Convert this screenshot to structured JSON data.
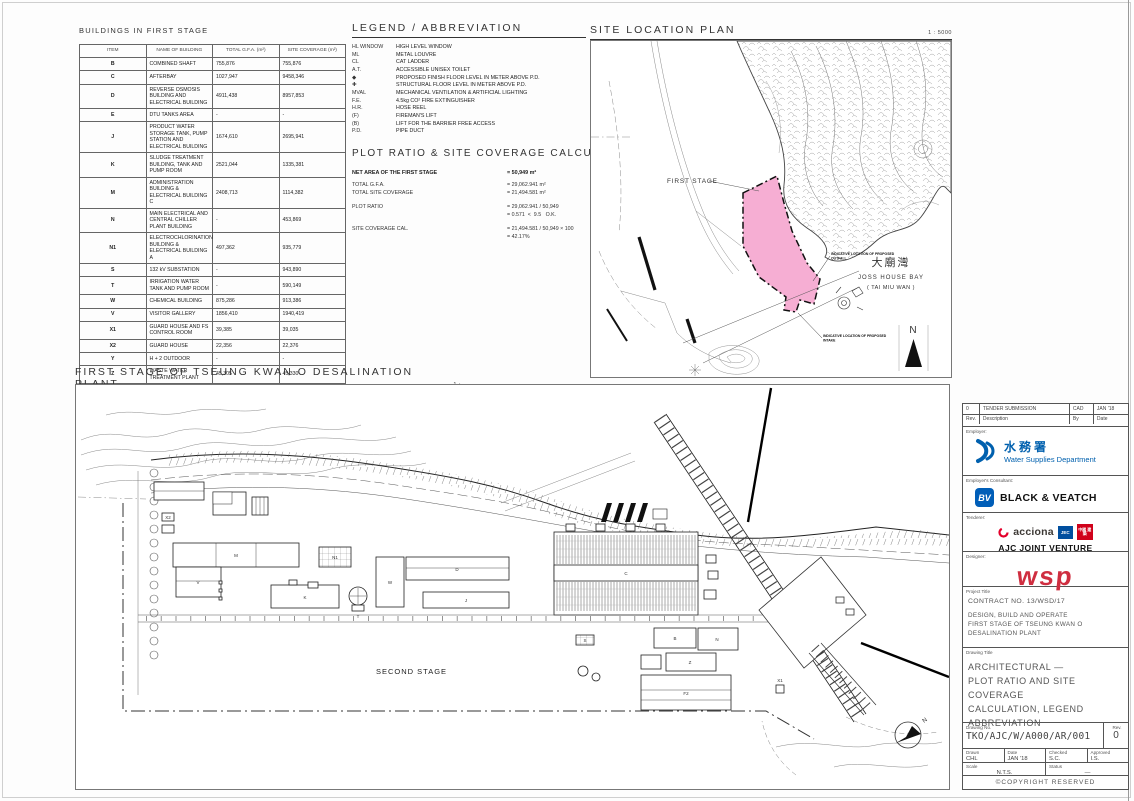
{
  "buildings_table": {
    "title": "BUILDINGS IN FIRST STAGE",
    "headers": [
      "ITEM",
      "NAME OF BUILDING",
      "TOTAL G.F.A. (m²)",
      "SITE COVERAGE (m²)"
    ],
    "rows": [
      {
        "item": "B",
        "name": "COMBINED SHAFT",
        "gfa": "755,876",
        "coverage": "755,876"
      },
      {
        "item": "C",
        "name": "AFTERBAY",
        "gfa": "1027,947",
        "coverage": "9458,346"
      },
      {
        "item": "D",
        "name": "REVERSE OSMOSIS BUILDING AND ELECTRICAL BUILDING",
        "gfa": "4911,438",
        "coverage": "8957,853"
      },
      {
        "item": "E",
        "name": "DTU TANKS AREA",
        "gfa": "-",
        "coverage": "-"
      },
      {
        "item": "J",
        "name": "PRODUCT WATER STORAGE TANK, PUMP STATION AND ELECTRICAL BUILDING",
        "gfa": "1674,610",
        "coverage": "2695,941"
      },
      {
        "item": "K",
        "name": "SLUDGE TREATMENT BUILDING, TANK AND PUMP ROOM",
        "gfa": "2521,044",
        "coverage": "1335,381"
      },
      {
        "item": "M",
        "name": "ADMINISTRATION BUILDING & ELECTRICAL BUILDING C",
        "gfa": "2408,713",
        "coverage": "1114,382"
      },
      {
        "item": "N",
        "name": "MAIN ELECTRICAL AND CENTRAL CHILLER PLANT BUILDING",
        "gfa": "-",
        "coverage": "453,869"
      },
      {
        "item": "N1",
        "name": "ELECTROCHLORINATION BUILDING & ELECTRICAL BUILDING A",
        "gfa": "497,362",
        "coverage": "935,779"
      },
      {
        "item": "S",
        "name": "132 kV SUBSTATION",
        "gfa": "-",
        "coverage": "943,890"
      },
      {
        "item": "T",
        "name": "IRRIGATION WATER TANK AND PUMP ROOM",
        "gfa": "-",
        "coverage": "590,149"
      },
      {
        "item": "W",
        "name": "CHEMICAL BUILDING",
        "gfa": "875,286",
        "coverage": "913,386"
      },
      {
        "item": "V",
        "name": "VISITOR GALLERY",
        "gfa": "1856,410",
        "coverage": "1940,419"
      },
      {
        "item": "X1",
        "name": "GUARD HOUSE AND FS CONTROL ROOM",
        "gfa": "39,385",
        "coverage": "39,035"
      },
      {
        "item": "X2",
        "name": "GUARD HOUSE",
        "gfa": "22,356",
        "coverage": "22,376"
      },
      {
        "item": "Y",
        "name": "H + 2 OUTDOOR",
        "gfa": "-",
        "coverage": "-"
      },
      {
        "item": "Z",
        "name": "WASTE WATER TREATMENT PLANT",
        "gfa": "45,305",
        "coverage": "45,330"
      }
    ],
    "total_label": "TOTAL =",
    "total_gfa": "29175,523",
    "total_coverage": "21494,225"
  },
  "legend": {
    "title": "LEGEND / ABBREVIATION",
    "items": [
      {
        "symbol": "HL WINDOW",
        "meaning": "HIGH LEVEL WINDOW"
      },
      {
        "symbol": "ML",
        "meaning": "METAL LOUVRE"
      },
      {
        "symbol": "CL",
        "meaning": "CAT LADDER"
      },
      {
        "symbol": "A.T.",
        "meaning": "ACCESSIBLE UNISEX TOILET"
      },
      {
        "symbol": "◆",
        "meaning": "PROPOSED FINISH FLOOR LEVEL IN METER ABOVE P.D."
      },
      {
        "symbol": "✚",
        "meaning": "STRUCTURAL FLOOR LEVEL IN METER ABOVE P.D."
      },
      {
        "symbol": "MVAL",
        "meaning": "MECHANICAL VENTILATION & ARTIFICIAL LIGHTING"
      },
      {
        "symbol": "F.E.",
        "meaning": "4.5kg CO² FIRE EXTINGUISHER"
      },
      {
        "symbol": "H.R.",
        "meaning": "HOSE REEL"
      },
      {
        "symbol": "(F)",
        "meaning": "FIREMAN'S LIFT"
      },
      {
        "symbol": "(B)",
        "meaning": "LIFT FOR THE BARRIER FREE ACCESS"
      },
      {
        "symbol": "P.D.",
        "meaning": "PIPE DUCT"
      }
    ]
  },
  "plot_ratio": {
    "title": "PLOT RATIO & SITE COVERAGE CALCULATION:",
    "net_label": "NET AREA OF THE FIRST STAGE",
    "net_value": "= 50,949 m²",
    "lines": [
      {
        "label": "TOTAL G.F.A.",
        "value": "= 29,062.941 m²"
      },
      {
        "label": "TOTAL SITE COVERAGE",
        "value": "= 21,494.581 m²"
      },
      {
        "label": "PLOT RATIO",
        "value": "= 29,062.941 / 50,949"
      },
      {
        "label": "",
        "value": "= 0.571  <  9.5   O.K."
      },
      {
        "label": "SITE COVERAGE CAL.",
        "value": "= 21,494.581 / 50,949 × 100"
      },
      {
        "label": "",
        "value": "= 42.17%"
      }
    ]
  },
  "site_location": {
    "title": "SITE LOCATION PLAN",
    "scale": "1 : 5000",
    "first_stage_label": "FIRST STAGE",
    "bay_cn": "大廟灣",
    "bay_en": "JOSS HOUSE BAY",
    "bay_en2": "( TAI MIU WAN )",
    "callout_outfall_1": "INDICATIVE LOCATION OF PROPOSED",
    "callout_outfall_2": "OUTFALL",
    "callout_intake_1": "INDICATIVE LOCATION OF PROPOSED",
    "callout_intake_2": "INTAKE",
    "north_label": "N",
    "pink": "#f6aed3"
  },
  "site_plan": {
    "title": "FIRST STAGE OF TSEUNG KWAN O DESALINATION PLANT",
    "scale": "1 : 1000",
    "second_stage_label": "SECOND STAGE",
    "north_label": "N",
    "labels": [
      {
        "text": "X2"
      },
      {
        "text": "M"
      },
      {
        "text": "V"
      },
      {
        "text": "N1"
      },
      {
        "text": "K"
      },
      {
        "text": "T"
      },
      {
        "text": "W"
      },
      {
        "text": "D"
      },
      {
        "text": "J"
      },
      {
        "text": "S"
      },
      {
        "text": "C"
      },
      {
        "text": "B"
      },
      {
        "text": "N"
      },
      {
        "text": "Z"
      },
      {
        "text": "F2"
      },
      {
        "text": "X1"
      }
    ]
  },
  "title_block": {
    "rev_row": {
      "rev": "0",
      "description": "TENDER SUBMISSION",
      "by": "CAD",
      "date": "JAN '18"
    },
    "rev_headers": {
      "rev": "Rev.",
      "description": "Description",
      "by": "By",
      "date": "Date"
    },
    "employer_label": "Employer:",
    "wsd_cn": "水務署",
    "wsd_en": "Water Supplies Department",
    "consultant_label": "Employer's Consultant:",
    "bv_mono": "BV",
    "bv_name": "BLACK & VEATCH",
    "tenderer_label": "Tenderer:",
    "acciona": "acciona",
    "jec": "JEC",
    "cscec": "中國 建築",
    "ajc_name": "AJC JOINT VENTURE",
    "designer_label": "Designer:",
    "wsp": "wsp",
    "project_label": "Project Title",
    "contract": "CONTRACT NO. 13/WSD/17",
    "project_lines": {
      "l1": "DESIGN, BUILD AND OPERATE",
      "l2": "FIRST STAGE OF TSEUNG KWAN O",
      "l3": "DESALINATION PLANT"
    },
    "drawing_title_label": "Drawing Title",
    "drawing_title_lines": {
      "l1": "ARCHITECTURAL —",
      "l2": "PLOT RATIO AND SITE COVERAGE",
      "l3": "CALCULATION, LEGEND",
      "l4": "ABBREVIATION"
    },
    "drawing_no_label": "Drawing No.",
    "drawing_no": "TKO/AJC/W/A000/AR/001",
    "rev_label": "Rev.",
    "rev": "0",
    "drawn_label": "Drawn",
    "drawn": "CHL",
    "date_label": "Date",
    "date": "JAN '18",
    "checked_label": "Checked",
    "checked": "S.C.",
    "approved_label": "Approved",
    "approved": "I.S.",
    "scale_label": "Scale",
    "scale": "N.T.S.",
    "status_label": "Status",
    "status": "—",
    "copyright": "©COPYRIGHT RESERVED"
  }
}
